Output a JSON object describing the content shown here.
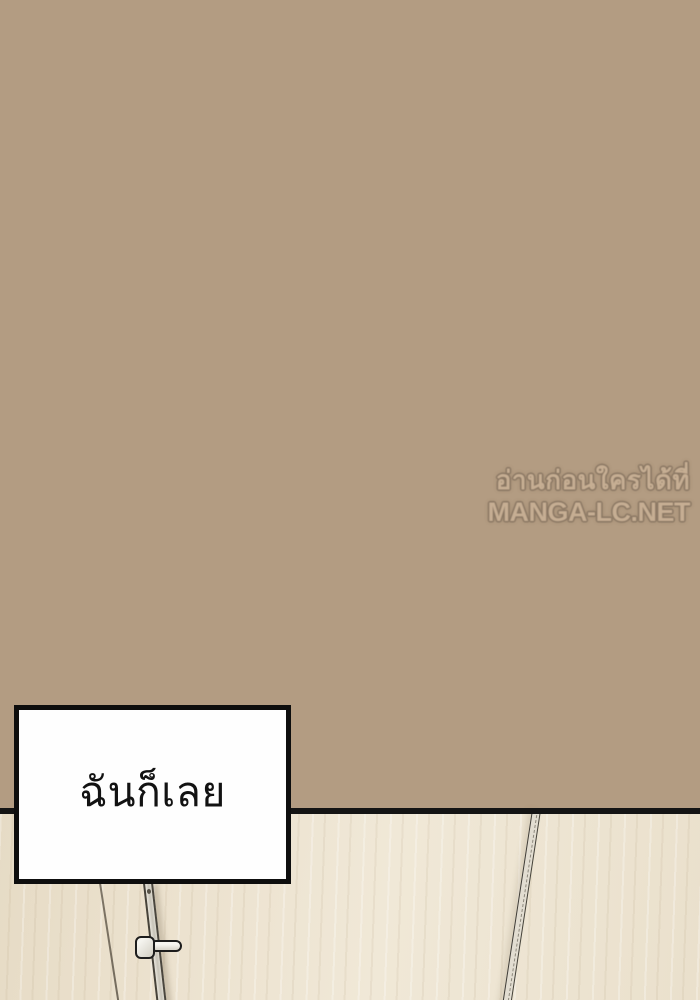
{
  "page": {
    "type": "manga-panel",
    "width": 700,
    "height": 1000
  },
  "colors": {
    "wall-brown": "#b39c82",
    "floor-cream": "#ece2cf",
    "divider-black": "#141414",
    "wm-fill": "#c6ae93",
    "wm-outline": "#8a7763",
    "box-border": "#0e0e0e",
    "box-fill": "#fefefe"
  },
  "watermark": {
    "line1": "อ่านก่อนใครได้ที่",
    "line2": "MANGA-LC.NET"
  },
  "speech_box": {
    "text": "ฉันก็เลย"
  }
}
